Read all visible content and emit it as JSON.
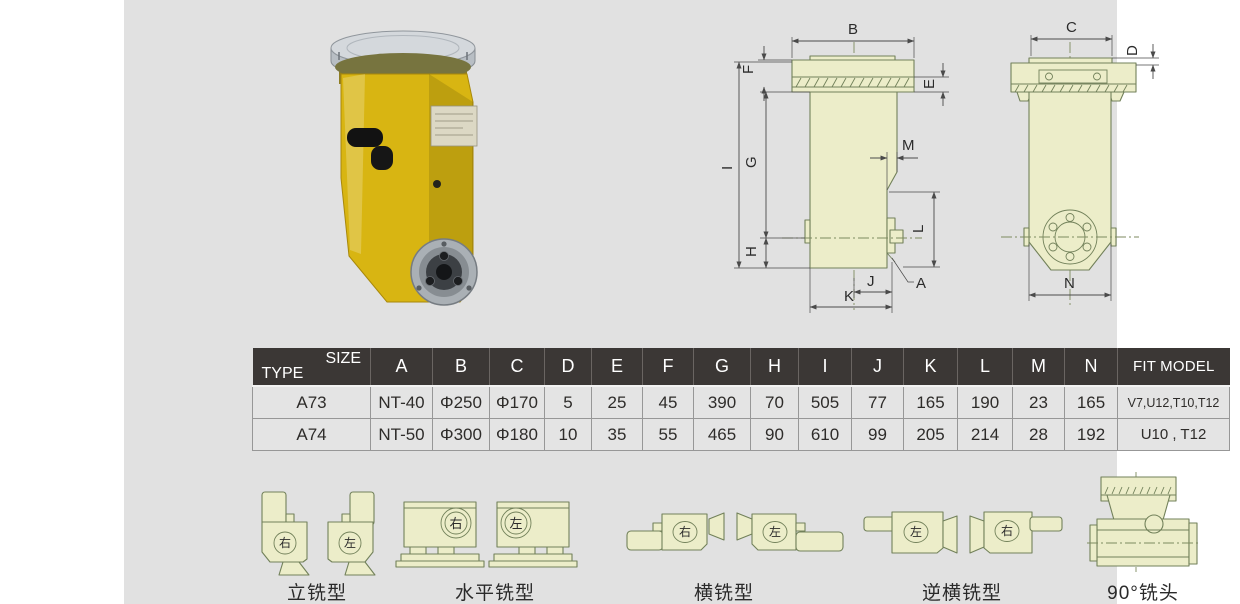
{
  "table": {
    "corner": {
      "size_label": "SIZE",
      "type_label": "TYPE"
    },
    "columns": [
      "A",
      "B",
      "C",
      "D",
      "E",
      "F",
      "G",
      "H",
      "I",
      "J",
      "K",
      "L",
      "M",
      "N",
      "FIT MODEL"
    ],
    "rows": [
      {
        "type": "A73",
        "values": [
          "NT-40",
          "Φ250",
          "Φ170",
          "5",
          "25",
          "45",
          "390",
          "70",
          "505",
          "77",
          "165",
          "190",
          "23",
          "165",
          "V7,U12,T10,T12"
        ]
      },
      {
        "type": "A74",
        "values": [
          "NT-50",
          "Φ300",
          "Φ180",
          "10",
          "35",
          "55",
          "465",
          "90",
          "610",
          "99",
          "205",
          "214",
          "28",
          "192",
          "U10 , T12"
        ]
      }
    ]
  },
  "drawings": {
    "front": {
      "dims": {
        "B": "B",
        "F": "F",
        "E": "E",
        "I": "I",
        "G": "G",
        "H": "H",
        "M": "M",
        "L": "L",
        "J": "J",
        "K": "K",
        "A": "A"
      }
    },
    "side": {
      "dims": {
        "C": "C",
        "D": "D",
        "N": "N"
      }
    }
  },
  "variants": {
    "vertical": {
      "label": "立铣型",
      "first_badge": "右",
      "second_badge": "左"
    },
    "horizontal": {
      "label": "水平铣型",
      "first_badge": "右",
      "second_badge": "左"
    },
    "cross": {
      "label": "横铣型",
      "first_badge": "右",
      "second_badge": "左"
    },
    "reverse_cross": {
      "label": "逆横铣型",
      "first_badge": "左",
      "second_badge": "右"
    },
    "ninety": {
      "label": "90°铣头"
    }
  },
  "colors": {
    "panel_bg": "#e1e1e1",
    "table_header_bg": "#3b3735",
    "product_yellow": "#d8b512",
    "diagram_fill": "#ecedc9",
    "diagram_stroke": "#72815a"
  }
}
